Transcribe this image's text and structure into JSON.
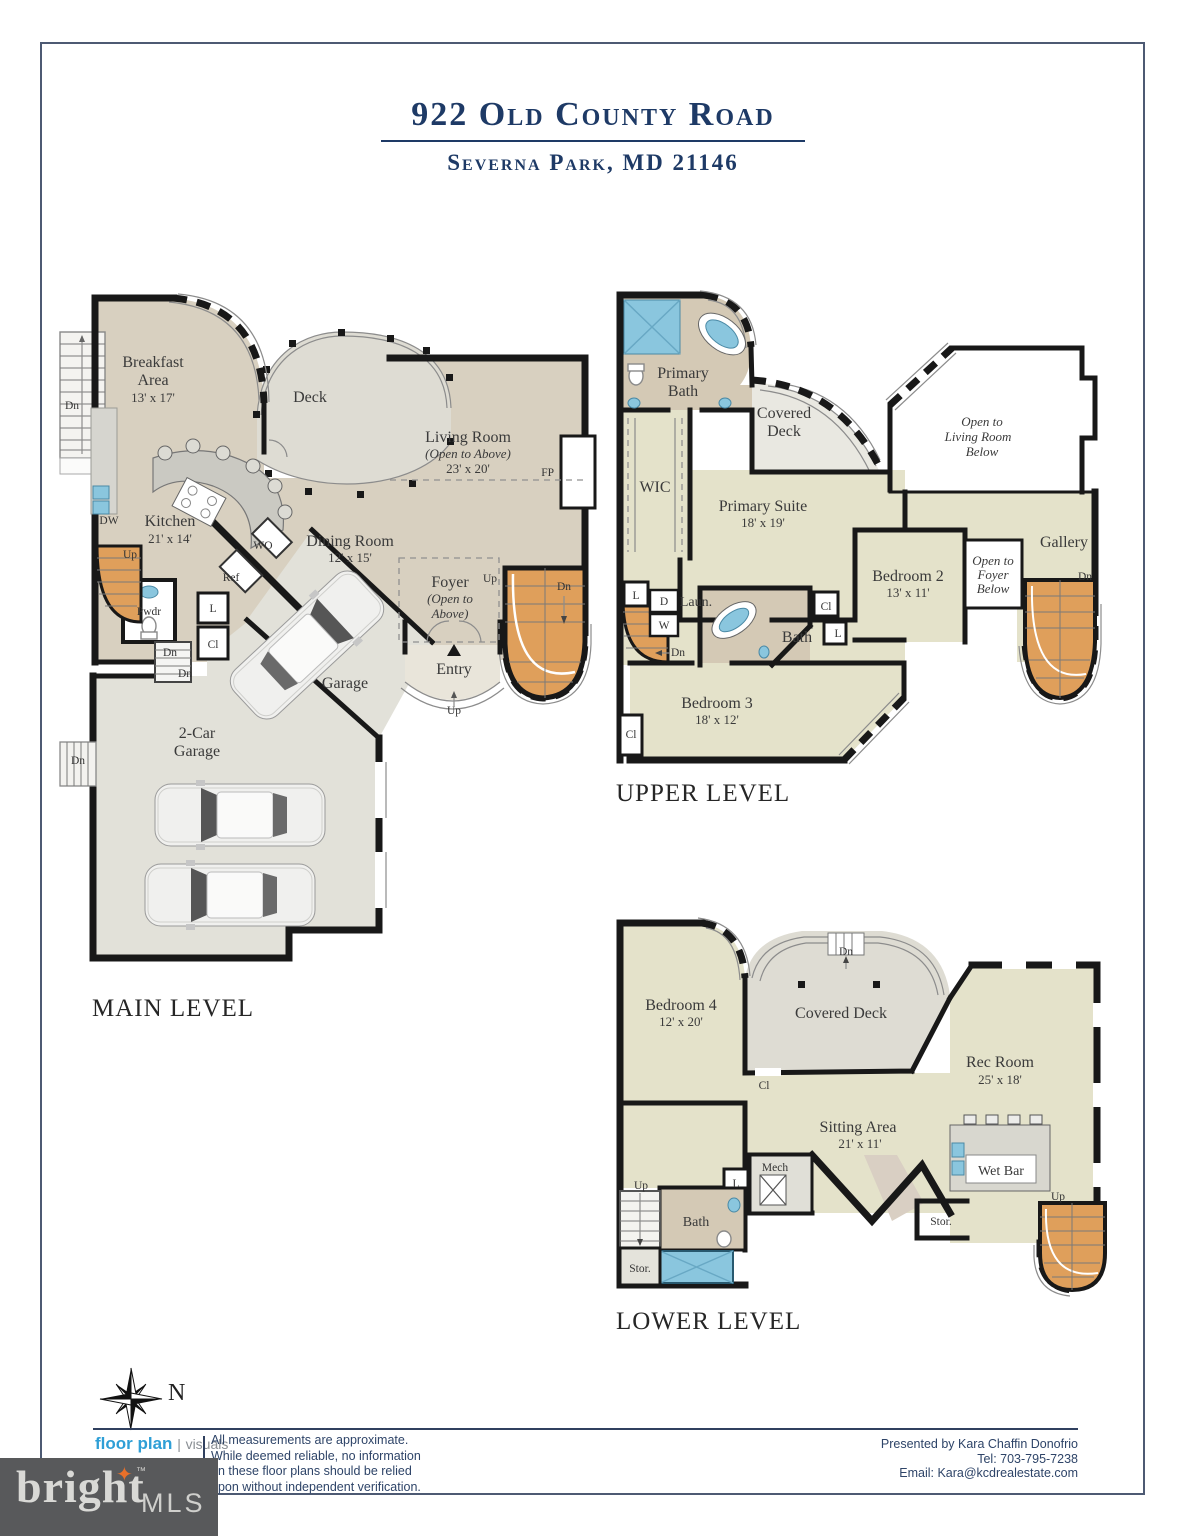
{
  "title": {
    "address": "922 Old County Road",
    "location": "Severna Park, MD 21146"
  },
  "levels": {
    "main": {
      "label": "MAIN LEVEL",
      "rooms": {
        "breakfast": {
          "l1": "Breakfast",
          "l2": "Area",
          "dims": "13' x 17'"
        },
        "deck": "Deck",
        "living": {
          "name": "Living Room",
          "note": "(Open to Above)",
          "dims": "23' x 20'"
        },
        "kitchen": {
          "name": "Kitchen",
          "dims": "21' x 14'"
        },
        "dining": {
          "name": "Dining Room",
          "dims": "12' x 15'"
        },
        "foyer": {
          "name": "Foyer",
          "note1": "(Open to",
          "note2": "Above)"
        },
        "entry": "Entry",
        "garage": "Garage",
        "two_car": {
          "l1": "2-Car",
          "l2": "Garage"
        },
        "pwdr": "Pwdr"
      }
    },
    "upper": {
      "label": "UPPER LEVEL",
      "rooms": {
        "primary_bath": {
          "l1": "Primary",
          "l2": "Bath"
        },
        "covered_deck": {
          "l1": "Covered",
          "l2": "Deck"
        },
        "open_living": {
          "l1": "Open to",
          "l2": "Living Room",
          "l3": "Below"
        },
        "wic": "WIC",
        "primary_suite": {
          "name": "Primary Suite",
          "dims": "18' x 19'"
        },
        "bedroom2": {
          "name": "Bedroom 2",
          "dims": "13' x 11'"
        },
        "gallery": "Gallery",
        "open_foyer": {
          "l1": "Open to",
          "l2": "Foyer",
          "l3": "Below"
        },
        "laundry": "Laun.",
        "bath": "Bath",
        "bedroom3": {
          "name": "Bedroom 3",
          "dims": "18' x 12'"
        }
      }
    },
    "lower": {
      "label": "LOWER LEVEL",
      "rooms": {
        "bedroom4": {
          "name": "Bedroom 4",
          "dims": "12' x 20'"
        },
        "covered_deck": "Covered Deck",
        "rec_room": {
          "name": "Rec Room",
          "dims": "25' x 18'"
        },
        "sitting": {
          "name": "Sitting Area",
          "dims": "21' x 11'"
        },
        "wet_bar": "Wet Bar",
        "bath": "Bath",
        "mech": "Mech",
        "stor": "Stor."
      }
    }
  },
  "abbr": {
    "up": "Up",
    "dn": "Dn",
    "cl": "Cl",
    "l": "L",
    "d": "D",
    "w": "W",
    "ref": "Ref",
    "wo": "WO",
    "dw": "DW",
    "fp": "FP"
  },
  "compass": {
    "north": "N"
  },
  "footer": {
    "logo": {
      "primary": "floor plan",
      "secondary": "visuals"
    },
    "disclaimer_lines": [
      "All measurements are approximate.",
      "While deemed reliable, no information",
      "on these floor plans should be relied",
      "upon without independent verification."
    ],
    "presented": {
      "by": "Presented by Kara Chaffin Donofrio",
      "tel": "Tel: 703-795-7238",
      "email": "Email: Kara@kcdrealestate.com"
    }
  },
  "brand": {
    "name": "bright",
    "suffix": "MLS",
    "tm": "™",
    "star_icon": "✦"
  }
}
